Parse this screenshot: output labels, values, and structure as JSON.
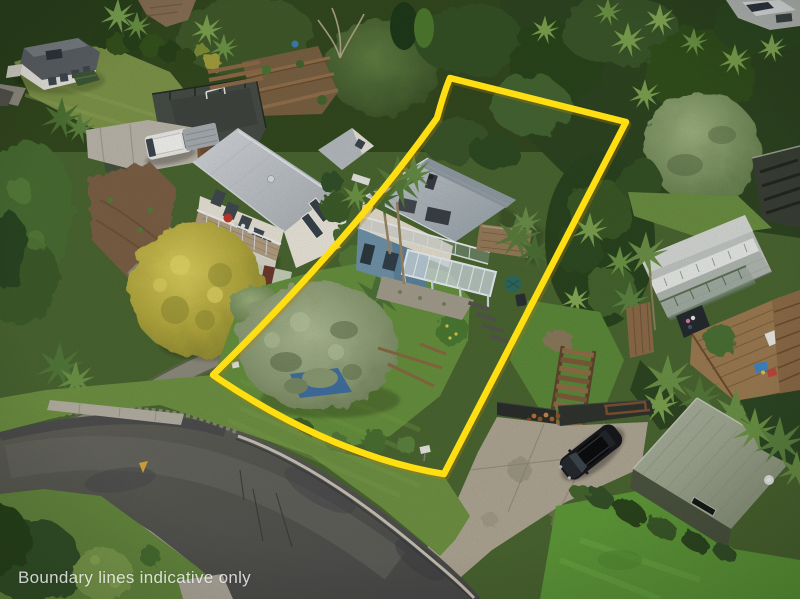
{
  "image": {
    "type": "aerial-drone-photograph",
    "watermark": "Boundary lines indicative only"
  },
  "boundary": {
    "color": "#ffde12",
    "path": "M450,78 C444,92 441,104 437,118 Q350,240 213,375 Q330,455 444,474 L626,122 Z"
  },
  "scene_objects": [
    "subject-house",
    "neighbor-house-left",
    "top-left-house",
    "right-deck-house",
    "green-shed",
    "black-car",
    "white-van",
    "wooden-stairs",
    "olive-tree",
    "golden-tree",
    "road",
    "concrete-driveway",
    "gravel-path",
    "retaining-walls",
    "letterbox"
  ]
}
